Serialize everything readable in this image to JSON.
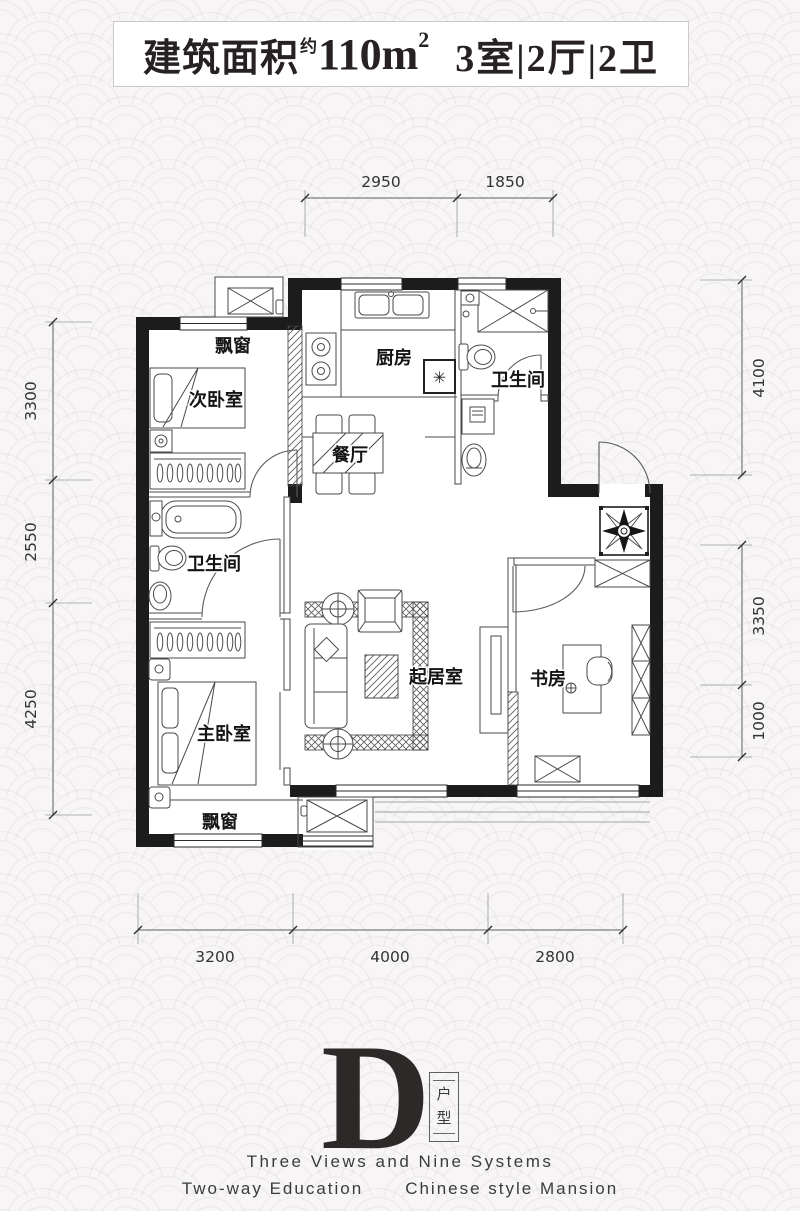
{
  "title": {
    "prefix": "建筑面积",
    "approx": "约",
    "area": "110m",
    "area_exp": "2",
    "rooms": "3室|2厅|2卫"
  },
  "rooms": {
    "bay_top": "飘窗",
    "secondary_bedroom": "次卧室",
    "kitchen": "厨房",
    "bath_top": "卫生间",
    "dining": "餐厅",
    "bath_left": "卫生间",
    "master_bedroom": "主卧室",
    "living": "起居室",
    "study": "书房",
    "bay_bottom": "飘窗"
  },
  "kitchen_symbol": "✳",
  "dims": {
    "top": [
      "2950",
      "1850"
    ],
    "left": [
      "3300",
      "2550",
      "4250"
    ],
    "right": [
      "4100",
      "3350",
      "1000"
    ],
    "bottom": [
      "3200",
      "4000",
      "2800"
    ]
  },
  "logo": {
    "letter": "D",
    "type_top": "户",
    "type_bottom": "型",
    "line1": "Three Views and Nine Systems",
    "line2a": "Two-way Education",
    "line2b": "Chinese style Mansion"
  }
}
